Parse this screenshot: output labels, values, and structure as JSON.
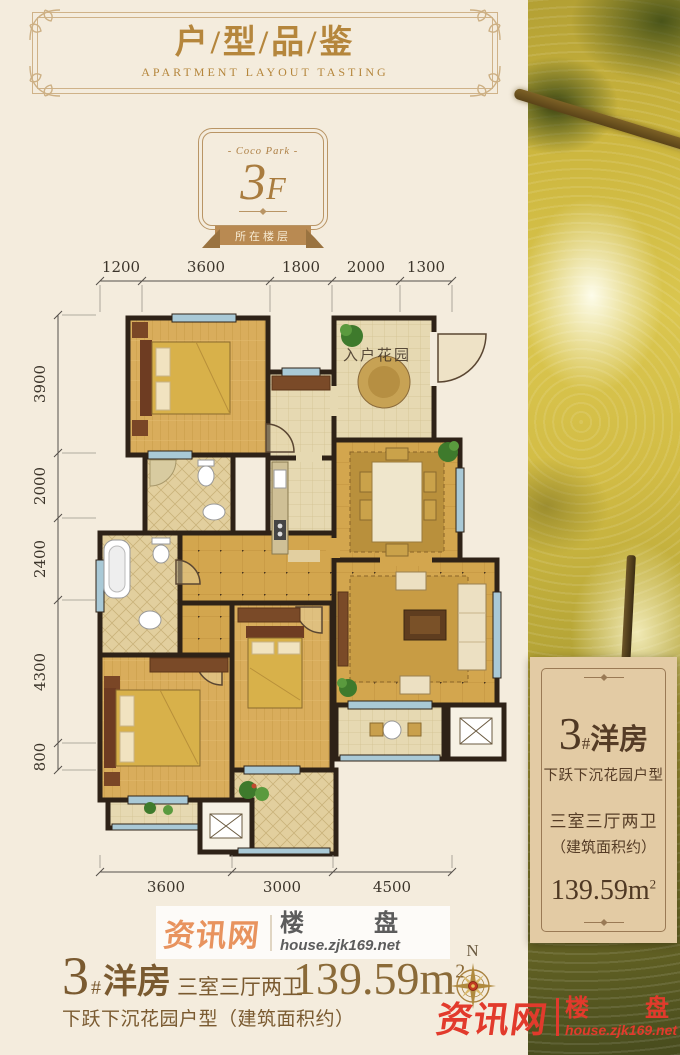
{
  "header": {
    "title": "户/型/品/鉴",
    "subtitle": "APARTMENT LAYOUT TASTING"
  },
  "badge": {
    "top_label": "- Coco Park -",
    "floor_number": "3",
    "floor_suffix": "F",
    "ribbon": "所在楼层"
  },
  "plan": {
    "room_label": "入户花园",
    "dims_top": [
      "1200",
      "3600",
      "1800",
      "2000",
      "1300"
    ],
    "dims_left": [
      "3900",
      "2000",
      "2400",
      "4300",
      "800"
    ],
    "dims_bottom": [
      "3600",
      "3000",
      "4500"
    ]
  },
  "card": {
    "number": "3",
    "hash": "#",
    "type": "洋房",
    "subtitle": "下跃下沉花园户型",
    "rooms": "三室三厅两卫",
    "note": "（建筑面积约）",
    "area": "139.59m",
    "area_sup": "2"
  },
  "bottom_info": {
    "number": "3",
    "hash": "#",
    "type": "洋房",
    "rooms": "三室三厅两卫",
    "desc": "下跃下沉花园户型（建筑面积约）",
    "area": "139.59m",
    "area_sup": "2"
  },
  "watermark_gray": {
    "brand": "资讯网",
    "word1": "楼",
    "word2": "盘",
    "url": "house.zjk169.net"
  },
  "watermark_red": {
    "brand": "资讯网",
    "word1": "楼",
    "word2": "盘",
    "url": "house.zjk169.net"
  },
  "compass": {
    "north_label": "N"
  },
  "colors": {
    "background": "#f4ecdd",
    "gold_text": "#b5863c",
    "wall": "#2e2217",
    "floor_gold": "#d3a64e",
    "card_bg": "#e3cba4",
    "red_watermark": "#e23a2c",
    "orange_brand": "#e8935e",
    "window_blue": "#a9c9d6"
  }
}
